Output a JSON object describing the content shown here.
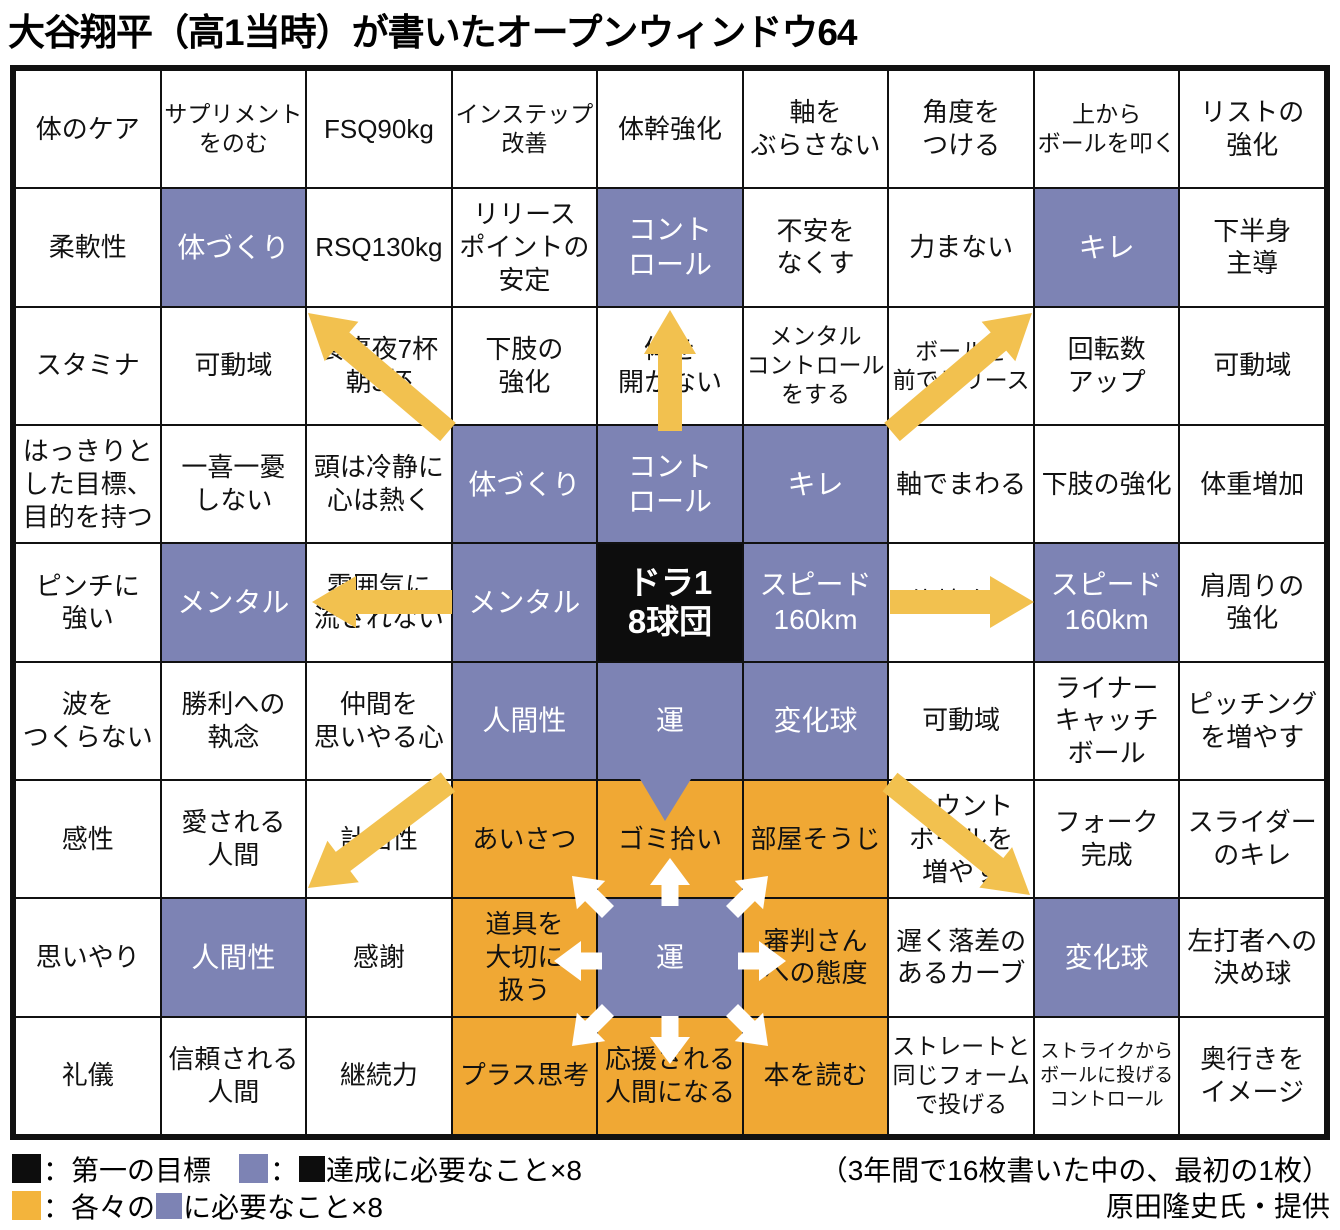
{
  "title": "大谷翔平（高1当時）が書いたオープンウィンドウ64",
  "colors": {
    "purple": "#7d83b4",
    "orange": "#f0a834",
    "arrow_yellow": "#f2c14f",
    "arrow_white": "#ffffff",
    "goal_black": "#0d0d0d",
    "legend_orange": "#f3b43c",
    "grid_line": "#111111"
  },
  "grid": {
    "rows": 9,
    "cols": 9,
    "cells": [
      [
        {
          "text": "体のケア",
          "style": "w"
        },
        {
          "text": "サプリメント\nをのむ",
          "style": "w"
        },
        {
          "text": "FSQ90kg",
          "style": "w"
        },
        {
          "text": "インステップ\n改善",
          "style": "w"
        },
        {
          "text": "体幹強化",
          "style": "w"
        },
        {
          "text": "軸を\nぶらさない",
          "style": "w"
        },
        {
          "text": "角度を\nつける",
          "style": "w"
        },
        {
          "text": "上から\nボールを叩く",
          "style": "w"
        },
        {
          "text": "リストの\n強化",
          "style": "w"
        }
      ],
      [
        {
          "text": "柔軟性",
          "style": "w"
        },
        {
          "text": "体づくり",
          "style": "p"
        },
        {
          "text": "RSQ130kg",
          "style": "w"
        },
        {
          "text": "リリース\nポイントの\n安定",
          "style": "w"
        },
        {
          "text": "コント\nロール",
          "style": "p"
        },
        {
          "text": "不安を\nなくす",
          "style": "w"
        },
        {
          "text": "力まない",
          "style": "w"
        },
        {
          "text": "キレ",
          "style": "p"
        },
        {
          "text": "下半身\n主導",
          "style": "w"
        }
      ],
      [
        {
          "text": "スタミナ",
          "style": "w"
        },
        {
          "text": "可動域",
          "style": "w"
        },
        {
          "text": "食事夜7杯\n朝3杯",
          "style": "w"
        },
        {
          "text": "下肢の\n強化",
          "style": "w"
        },
        {
          "text": "体を\n開かない",
          "style": "w"
        },
        {
          "text": "メンタル\nコントロール\nをする",
          "style": "w"
        },
        {
          "text": "ボールを\n前でリリース",
          "style": "w"
        },
        {
          "text": "回転数\nアップ",
          "style": "w"
        },
        {
          "text": "可動域",
          "style": "w"
        }
      ],
      [
        {
          "text": "はっきりと\nした目標、\n目的を持つ",
          "style": "w"
        },
        {
          "text": "一喜一憂\nしない",
          "style": "w"
        },
        {
          "text": "頭は冷静に\n心は熱く",
          "style": "w"
        },
        {
          "text": "体づくり",
          "style": "p"
        },
        {
          "text": "コント\nロール",
          "style": "p"
        },
        {
          "text": "キレ",
          "style": "p"
        },
        {
          "text": "軸でまわる",
          "style": "w"
        },
        {
          "text": "下肢の強化",
          "style": "w"
        },
        {
          "text": "体重増加",
          "style": "w"
        }
      ],
      [
        {
          "text": "ピンチに\n強い",
          "style": "w"
        },
        {
          "text": "メンタル",
          "style": "p"
        },
        {
          "text": "雰囲気に\n流されない",
          "style": "w"
        },
        {
          "text": "メンタル",
          "style": "p"
        },
        {
          "text": "ドラ1\n8球団",
          "style": "k"
        },
        {
          "text": "スピード\n160km",
          "style": "p"
        },
        {
          "text": "体幹強化",
          "style": "w"
        },
        {
          "text": "スピード\n160km",
          "style": "p"
        },
        {
          "text": "肩周りの\n強化",
          "style": "w"
        }
      ],
      [
        {
          "text": "波を\nつくらない",
          "style": "w"
        },
        {
          "text": "勝利への\n執念",
          "style": "w"
        },
        {
          "text": "仲間を\n思いやる心",
          "style": "w"
        },
        {
          "text": "人間性",
          "style": "p"
        },
        {
          "text": "運",
          "style": "p"
        },
        {
          "text": "変化球",
          "style": "p"
        },
        {
          "text": "可動域",
          "style": "w"
        },
        {
          "text": "ライナー\nキャッチ\nボール",
          "style": "w"
        },
        {
          "text": "ピッチング\nを増やす",
          "style": "w"
        }
      ],
      [
        {
          "text": "感性",
          "style": "w"
        },
        {
          "text": "愛される\n人間",
          "style": "w"
        },
        {
          "text": "計画性",
          "style": "w"
        },
        {
          "text": "あいさつ",
          "style": "o"
        },
        {
          "text": "ゴミ拾い",
          "style": "o"
        },
        {
          "text": "部屋そうじ",
          "style": "o"
        },
        {
          "text": "カウント\nボールを\n増やす",
          "style": "w"
        },
        {
          "text": "フォーク\n完成",
          "style": "w"
        },
        {
          "text": "スライダー\nのキレ",
          "style": "w"
        }
      ],
      [
        {
          "text": "思いやり",
          "style": "w"
        },
        {
          "text": "人間性",
          "style": "p"
        },
        {
          "text": "感謝",
          "style": "w"
        },
        {
          "text": "道具を\n大切に\n扱う",
          "style": "o"
        },
        {
          "text": "運",
          "style": "p"
        },
        {
          "text": "審判さん\nへの態度",
          "style": "o"
        },
        {
          "text": "遅く落差の\nあるカーブ",
          "style": "w"
        },
        {
          "text": "変化球",
          "style": "p"
        },
        {
          "text": "左打者への\n決め球",
          "style": "w"
        }
      ],
      [
        {
          "text": "礼儀",
          "style": "w"
        },
        {
          "text": "信頼される\n人間",
          "style": "w"
        },
        {
          "text": "継続力",
          "style": "w"
        },
        {
          "text": "プラス思考",
          "style": "o"
        },
        {
          "text": "応援される\n人間になる",
          "style": "o"
        },
        {
          "text": "本を読む",
          "style": "o"
        },
        {
          "text": "ストレートと\n同じフォーム\nで投げる",
          "style": "w"
        },
        {
          "text": "ストライクから\nボールに投げる\nコントロール",
          "style": "w"
        },
        {
          "text": "奥行きを\nイメージ",
          "style": "w"
        }
      ]
    ]
  },
  "arrows": {
    "yellow": [
      {
        "name": "arrow-up-left",
        "tail": [
          438,
          367
        ],
        "tip": [
          298,
          248
        ]
      },
      {
        "name": "arrow-up",
        "tail": [
          660,
          366
        ],
        "tip": [
          660,
          245
        ]
      },
      {
        "name": "arrow-up-right",
        "tail": [
          882,
          367
        ],
        "tip": [
          1022,
          248
        ]
      },
      {
        "name": "arrow-left",
        "tail": [
          442,
          537
        ],
        "tip": [
          302,
          537
        ]
      },
      {
        "name": "arrow-right",
        "tail": [
          880,
          537
        ],
        "tip": [
          1024,
          537
        ]
      },
      {
        "name": "arrow-down-left",
        "tail": [
          438,
          717
        ],
        "tip": [
          298,
          823
        ]
      },
      {
        "name": "arrow-down-right",
        "tail": [
          880,
          717
        ],
        "tip": [
          1020,
          830
        ]
      }
    ],
    "purple_triangle": {
      "name": "arrow-down-purple",
      "points": [
        [
          630,
          714
        ],
        [
          681,
          714
        ],
        [
          655,
          756
        ]
      ]
    },
    "white": [
      {
        "name": "white-arrow-up",
        "tail": [
          660,
          841
        ],
        "tip": [
          660,
          793
        ]
      },
      {
        "name": "white-arrow-down",
        "tail": [
          660,
          951
        ],
        "tip": [
          660,
          999
        ]
      },
      {
        "name": "white-arrow-left",
        "tail": [
          592,
          896
        ],
        "tip": [
          544,
          896
        ]
      },
      {
        "name": "white-arrow-right",
        "tail": [
          728,
          896
        ],
        "tip": [
          776,
          896
        ]
      },
      {
        "name": "white-arrow-up-left",
        "tail": [
          598,
          847
        ],
        "tip": [
          562,
          811
        ]
      },
      {
        "name": "white-arrow-up-right",
        "tail": [
          722,
          847
        ],
        "tip": [
          758,
          811
        ]
      },
      {
        "name": "white-arrow-down-left",
        "tail": [
          598,
          945
        ],
        "tip": [
          562,
          981
        ]
      },
      {
        "name": "white-arrow-down-right",
        "tail": [
          722,
          945
        ],
        "tip": [
          758,
          981
        ]
      }
    ]
  },
  "legend": {
    "lines": [
      [
        {
          "swatch": "goal_black"
        },
        {
          "text": "：第一の目標"
        },
        {
          "gap": true
        },
        {
          "swatch": "purple"
        },
        {
          "text": "："
        },
        {
          "swatch": "goal_black",
          "small": true
        },
        {
          "text": "達成に必要なこと×8"
        }
      ],
      [
        {
          "swatch": "legend_orange"
        },
        {
          "text": "：各々の"
        },
        {
          "swatch": "purple",
          "small": true
        },
        {
          "text": "に必要なこと×8"
        }
      ]
    ],
    "credit1": "（3年間で16枚書いた中の、最初の1枚）",
    "credit2": "原田隆史氏・提供"
  }
}
